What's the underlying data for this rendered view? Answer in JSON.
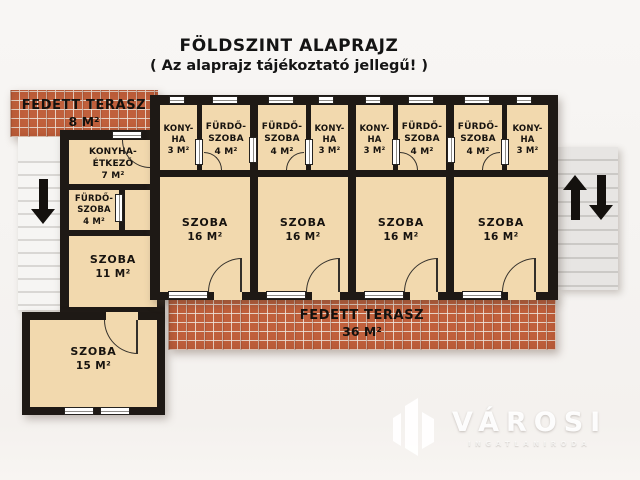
{
  "title": {
    "line1": "FÖLDSZINT ALAPRAJZ",
    "line2": "( Az alaprajz tájékoztató jellegű! )"
  },
  "terrace_top": {
    "name": "FEDETT TERASZ",
    "area": "8 M²"
  },
  "terrace_bottom": {
    "name": "FEDETT TERASZ",
    "area": "36 M²"
  },
  "left_wing": {
    "kitchen_dining": {
      "name": "KONYHA-ÉTKEZŐ",
      "area": "7 M²"
    },
    "bathroom": {
      "line1": "FÜRDŐ-",
      "line2": "SZOBA",
      "area": "4 M²"
    },
    "room11": {
      "name": "SZOBA",
      "area": "11 M²"
    },
    "room15": {
      "name": "SZOBA",
      "area": "15 M²"
    }
  },
  "units": [
    {
      "layout": "kitchen-left",
      "kitchen": {
        "line1": "KONY-",
        "line2": "HA",
        "area": "3 M²"
      },
      "bathroom": {
        "line1": "FÜRDŐ-",
        "line2": "SZOBA",
        "area": "4 M²"
      },
      "room": {
        "name": "SZOBA",
        "area": "16 M²"
      }
    },
    {
      "layout": "kitchen-right",
      "kitchen": {
        "line1": "KONY-",
        "line2": "HA",
        "area": "3 M²"
      },
      "bathroom": {
        "line1": "FÜRDŐ-",
        "line2": "SZOBA",
        "area": "4 M²"
      },
      "room": {
        "name": "SZOBA",
        "area": "16 M²"
      }
    },
    {
      "layout": "kitchen-left",
      "kitchen": {
        "line1": "KONY-",
        "line2": "HA",
        "area": "3 M²"
      },
      "bathroom": {
        "line1": "FÜRDŐ-",
        "line2": "SZOBA",
        "area": "4 M²"
      },
      "room": {
        "name": "SZOBA",
        "area": "16 M²"
      }
    },
    {
      "layout": "kitchen-right",
      "kitchen": {
        "line1": "KONY-",
        "line2": "HA",
        "area": "3 M²"
      },
      "bathroom": {
        "line1": "FÜRDŐ-",
        "line2": "SZOBA",
        "area": "4 M²"
      },
      "room": {
        "name": "SZOBA",
        "area": "16 M²"
      }
    }
  ],
  "stairs": {
    "left_icon": "down-arrow",
    "right_icons": [
      "up-arrow",
      "down-arrow"
    ]
  },
  "watermark": {
    "brand": "VÁROSI",
    "subtitle": "INGATLANIRODA",
    "logo_icon": "building-logo"
  },
  "colors": {
    "wall": "#1e1915",
    "room_fill": "#f2d9ae",
    "brick": "#c0603c",
    "stairs": "#e7e5e3",
    "background": "#f5f3f1"
  }
}
